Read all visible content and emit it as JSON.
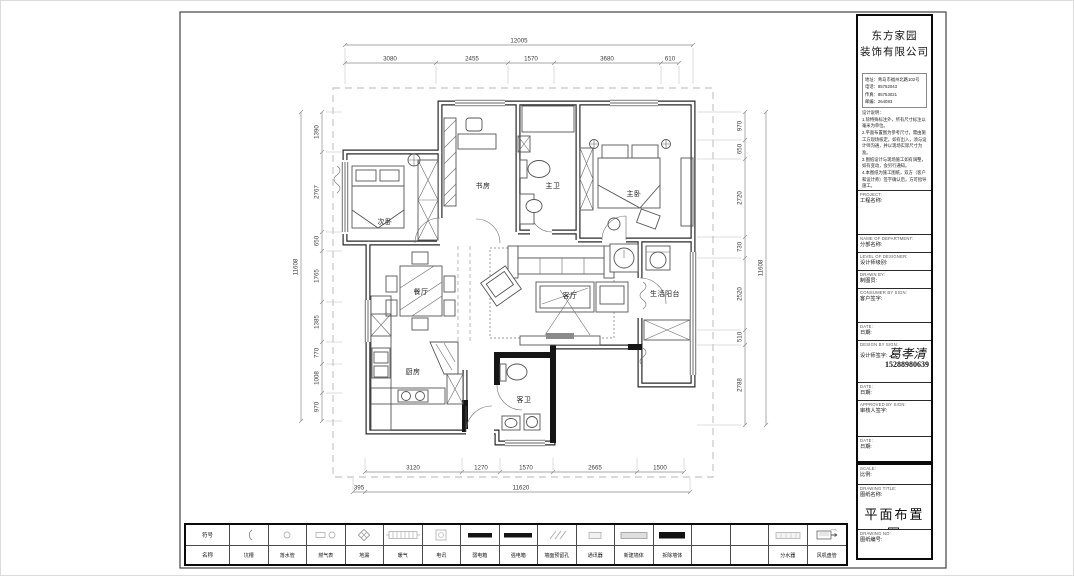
{
  "company": {
    "name_line1": "东方家园",
    "name_line2": "装饰有限公司",
    "address": "地址：青岛市福州北路102号",
    "phone": "电话：85752043",
    "fax": "传真：85753021",
    "zip": "邮编：264083"
  },
  "notes": {
    "title": "设计说明：",
    "items": [
      "1.除特殊标注外，所有尺寸标注以毫米为单位。",
      "2.平面布置图为参考尺寸，需由施工方现场核定，如有出入，须与设计师沟通，并以现场实际尺寸为准。",
      "3.图纸设计与现场施工如有调整，如有变动，会另行通知。",
      "4.本图纸为施工图纸，双方（客户和设计师）签字确认后，方可指导施工。"
    ]
  },
  "title_block": {
    "project_en": "PROJECT:",
    "project_cn": "工程名称:",
    "dept_en": "NAME OF DEPARTMENT:",
    "dept_cn": "分部名称:",
    "level_en": "LEVEL OF DESIGNER:",
    "level_cn": "设计师级别:",
    "drawn_en": "DRAWN BY:",
    "drawn_cn": "制图员:",
    "consumer_en": "CONSUMER BY SIGN:",
    "consumer_cn": "客户签字:",
    "date_en": "DATE:",
    "date_cn": "日期:",
    "design_en": "DESIGN BY SIGN:",
    "design_cn": "设计师签字:",
    "designer_name": "葛孝清",
    "designer_phone": "15288980639",
    "approved_en": "APPROVED BY SIGN:",
    "approved_cn": "审核人签字:",
    "scale_en": "SCALE:",
    "scale_cn": "比例:",
    "dtitle_en": "DRAWING TITLE:",
    "dtitle_cn": "图纸名称:",
    "drawing_title": "平面布置图",
    "dno_en": "DRAWING NO:",
    "dno_cn": "图纸编号:"
  },
  "legend": {
    "header_symbol": "符号",
    "header_name": "名称",
    "names": [
      "坑槽",
      "落水管",
      "燃气表",
      "地漏",
      "暖气",
      "电讯",
      "弱电箱",
      "强电箱",
      "墙面预留孔",
      "通讯器",
      "新建墙体",
      "拆除墙体",
      "",
      "",
      "分水器",
      "风机盘管"
    ]
  },
  "plan": {
    "rooms": {
      "bedroom2": "次卧",
      "study": "书房",
      "master_bath": "主卫",
      "master_bedroom": "主卧",
      "dining": "餐厅",
      "living": "客厅",
      "kitchen": "厨房",
      "guest_bath": "客卫",
      "balcony": "生活阳台"
    },
    "dims": {
      "top_total": "12005",
      "top": [
        "3080",
        "2455",
        "1570",
        "3680",
        "610"
      ],
      "bottom": [
        "3120",
        "1270",
        "1570",
        "2665",
        "1500"
      ],
      "bottom_offset": "395",
      "bottom_total": "11620",
      "left": [
        "1390",
        "2767",
        "650",
        "1765",
        "1385",
        "770",
        "1008",
        "970"
      ],
      "left_total": "11608",
      "right": [
        "970",
        "650",
        "2720",
        "730",
        "2520",
        "510",
        "2788"
      ],
      "right_total": "11608"
    }
  }
}
